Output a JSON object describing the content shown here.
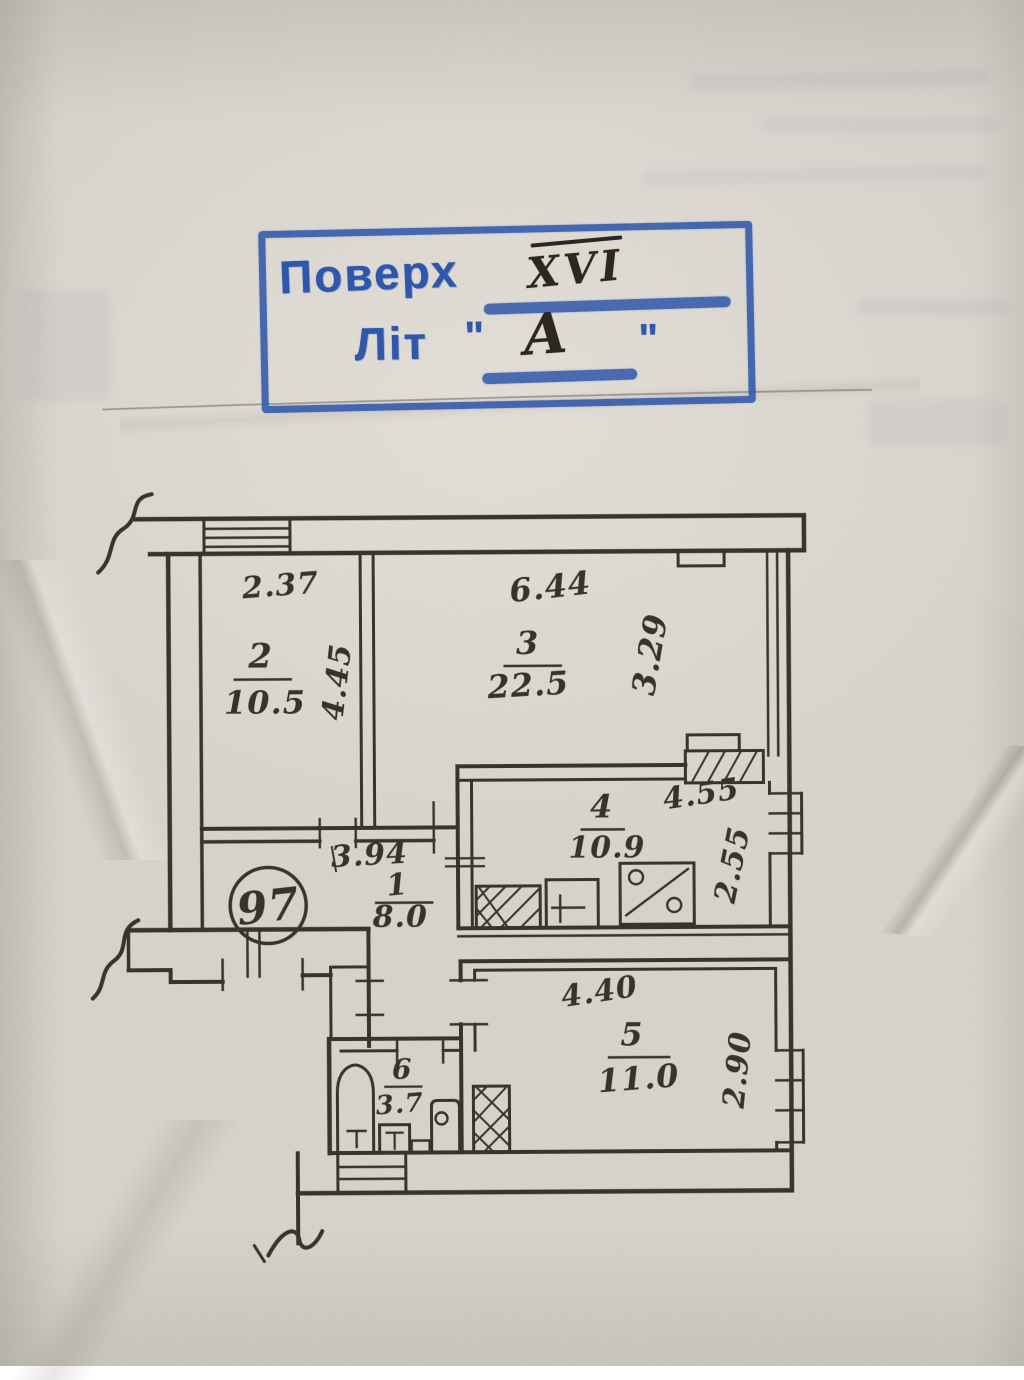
{
  "stamp": {
    "floor_label": "Поверх",
    "floor_value": "XVI",
    "letter_label": "Літ",
    "letter_quote_open": "\"",
    "letter_value": "А",
    "letter_quote_close": "\""
  },
  "plan": {
    "apartment_number": "97",
    "rooms": {
      "r1": {
        "number": "1",
        "area": "8.0"
      },
      "r2": {
        "number": "2",
        "area": "10.5"
      },
      "r3": {
        "number": "3",
        "area": "22.5"
      },
      "r4": {
        "number": "4",
        "area": "10.9"
      },
      "r5": {
        "number": "5",
        "area": "11.0"
      },
      "r6": {
        "number": "6",
        "area": "3.7"
      }
    },
    "dimensions": {
      "r2_w": "2.37",
      "r2_d": "4.45",
      "r3_w": "6.44",
      "r3_d": "3.29",
      "r4_w": "4.55",
      "r4_d": "2.55",
      "r1_w": "3.94",
      "r5_w": "4.40",
      "r5_d": "2.90"
    }
  },
  "colors": {
    "stamp_blue": "#2e55ab",
    "ink": "#2c251d",
    "paper": "#d7d3cc",
    "pencil": "#8b867d"
  }
}
